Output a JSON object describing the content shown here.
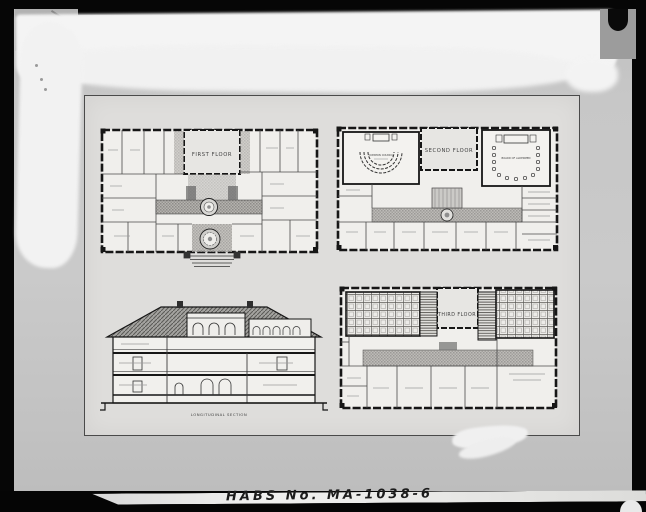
{
  "photo": {
    "habs_label": "HABS No. MA-1038-6"
  },
  "sheet": {
    "first_floor": {
      "title": "FIRST FLOOR"
    },
    "second_floor": {
      "title": "SECOND FLOOR",
      "left_chamber_label": "COMMON COUNCIL",
      "right_chamber_label": "BOARD OF ALDERMEN"
    },
    "third_floor": {
      "title": "THIRD FLOOR"
    },
    "section": {
      "title": "LONGITUDINAL SECTION"
    }
  },
  "colors": {
    "frame_black": "#060606",
    "photo_gray": "#c6c6c6",
    "sheet_gray": "#dedddb",
    "ink": "#1a1a1a",
    "paint_white": "#f4f4f4"
  }
}
